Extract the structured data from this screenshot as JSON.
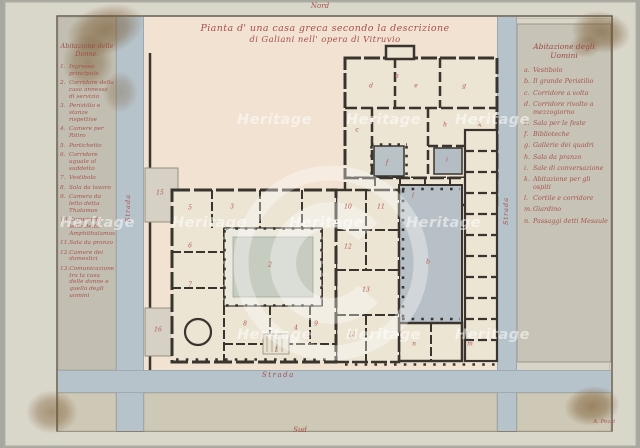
{
  "artwork": {
    "title_line1": "Pianta d' una casa greca secondo la descrizione",
    "title_line2": "di Galiani nell' opera di Vitruvio",
    "north_label": "Nord",
    "south_label": "Sud",
    "signature": "A. Pozzi"
  },
  "streets": {
    "left": "Strada",
    "right": "Strada",
    "bottom": "Strada"
  },
  "legend_left": {
    "header_line1": "Abitazione delle",
    "header_line2": "Donne.",
    "items": [
      {
        "num": "1.",
        "text": "Ingresso principale"
      },
      {
        "num": "2.",
        "text": "Corridore della casa annessa di servizio"
      },
      {
        "num": "3.",
        "text": "Peristilio e stanze rispettive"
      },
      {
        "num": "4.",
        "text": "Camere per Ritiro"
      },
      {
        "num": "5.",
        "text": "Portichetto"
      },
      {
        "num": "6.",
        "text": "Corridore uguale al suddetto"
      },
      {
        "num": "7.",
        "text": "Vestibolo"
      },
      {
        "num": "8.",
        "text": "Sala da lavoro"
      },
      {
        "num": "9.",
        "text": "Camera da letto detta Thalamos"
      },
      {
        "num": "10.",
        "text": "Camera da letto detta Amphithalamos"
      },
      {
        "num": "11.",
        "text": "Sala da pranzo"
      },
      {
        "num": "12.",
        "text": "Camere dei domestici"
      },
      {
        "num": "13.",
        "text": "Comunicazione tra la casa delle donne e quella degli uomini"
      }
    ]
  },
  "legend_right": {
    "header_line1": "Abitazione degli",
    "header_line2": "Uomini",
    "items": [
      {
        "num": "a.",
        "text": "Vestibolo"
      },
      {
        "num": "b.",
        "text": "Il grande Peristilio"
      },
      {
        "num": "c.",
        "text": "Corridore a volta"
      },
      {
        "num": "d.",
        "text": "Corridore rivolto a mezzogiorno"
      },
      {
        "num": "e.",
        "text": "Sala per le feste"
      },
      {
        "num": "f.",
        "text": "Biblioteche"
      },
      {
        "num": "g.",
        "text": "Gallerie dei quadri"
      },
      {
        "num": "h.",
        "text": "Sala da pranzo"
      },
      {
        "num": "i.",
        "text": "Sale di conversazione"
      },
      {
        "num": "k.",
        "text": "Abitazione per gli ospiti"
      },
      {
        "num": "l.",
        "text": "Cortile e corridore"
      },
      {
        "num": "m.",
        "text": "Giardino"
      },
      {
        "num": "n.",
        "text": "Passaggi detti Mesaule"
      }
    ]
  },
  "plan": {
    "labels": [
      {
        "t": "1",
        "x": 276,
        "y": 350
      },
      {
        "t": "2",
        "x": 270,
        "y": 265
      },
      {
        "t": "3",
        "x": 232,
        "y": 207
      },
      {
        "t": "4",
        "x": 296,
        "y": 328
      },
      {
        "t": "5",
        "x": 190,
        "y": 208
      },
      {
        "t": "6",
        "x": 190,
        "y": 246
      },
      {
        "t": "7",
        "x": 190,
        "y": 285
      },
      {
        "t": "8",
        "x": 245,
        "y": 324
      },
      {
        "t": "9",
        "x": 316,
        "y": 324
      },
      {
        "t": "10",
        "x": 348,
        "y": 207
      },
      {
        "t": "11",
        "x": 381,
        "y": 207
      },
      {
        "t": "12",
        "x": 348,
        "y": 247
      },
      {
        "t": "13",
        "x": 366,
        "y": 290
      },
      {
        "t": "14",
        "x": 352,
        "y": 335
      },
      {
        "t": "15",
        "x": 160,
        "y": 193
      },
      {
        "t": "16",
        "x": 158,
        "y": 330
      },
      {
        "t": "a",
        "x": 397,
        "y": 76
      },
      {
        "t": "b",
        "x": 428,
        "y": 262
      },
      {
        "t": "c",
        "x": 357,
        "y": 130
      },
      {
        "t": "d",
        "x": 371,
        "y": 86
      },
      {
        "t": "e",
        "x": 416,
        "y": 86
      },
      {
        "t": "f",
        "x": 387,
        "y": 163
      },
      {
        "t": "g",
        "x": 464,
        "y": 86
      },
      {
        "t": "h",
        "x": 445,
        "y": 125
      },
      {
        "t": "i",
        "x": 447,
        "y": 160
      },
      {
        "t": "k",
        "x": 480,
        "y": 125
      },
      {
        "t": "l",
        "x": 413,
        "y": 196
      },
      {
        "t": "m",
        "x": 470,
        "y": 344
      },
      {
        "t": "n",
        "x": 414,
        "y": 344
      }
    ]
  },
  "watermark": {
    "text": "Heritage",
    "positions": [
      {
        "x": 237,
        "y": 112
      },
      {
        "x": 346,
        "y": 112
      },
      {
        "x": 455,
        "y": 112
      },
      {
        "x": 60,
        "y": 215
      },
      {
        "x": 172,
        "y": 215
      },
      {
        "x": 289,
        "y": 215
      },
      {
        "x": 406,
        "y": 215
      },
      {
        "x": 237,
        "y": 327
      },
      {
        "x": 346,
        "y": 327
      },
      {
        "x": 455,
        "y": 327
      }
    ]
  },
  "colors": {
    "mount": "#a7a9a0",
    "paper": "#d9d6ca",
    "plan_field_pink": "#f1e2d2",
    "street_blue": "#b7c3cb",
    "panel_gray": "#c2bfb2",
    "block_tan": "#cec8b6",
    "wall_dark": "#39352e",
    "court_blue": "#b7c0c6",
    "court_green": "#c7ccc0",
    "ink_red": "#a94f48",
    "stain_brown": "#6e4a1d"
  }
}
